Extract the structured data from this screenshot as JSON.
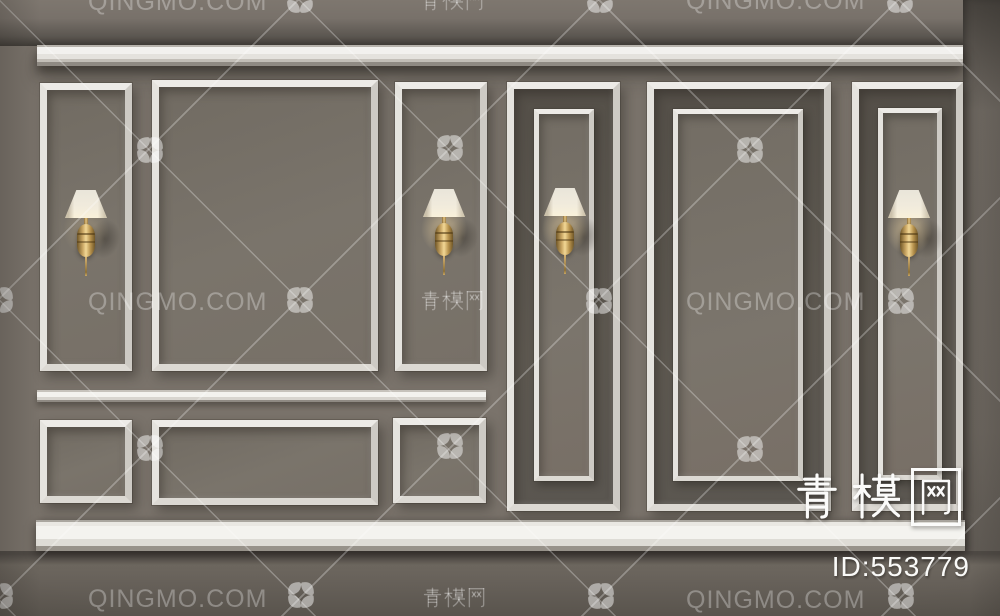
{
  "watermark": {
    "latin": "QINGMO.COM",
    "cn": "青模网"
  },
  "brand": {
    "name_cn": "青模网",
    "model_id": "ID:553779",
    "id_value": "553779"
  },
  "scene": {
    "subject": "wall panel molding with brass sconce lamps",
    "sconce_count": 4
  },
  "colors": {
    "wall": "#7a736b",
    "panel_recess": "#5d5850",
    "molding": "#f2f1ee",
    "brass": "#caa765",
    "floor": "#655f58",
    "watermark": "rgba(255,255,255,0.30)",
    "brand_text": "#fbfbfa"
  }
}
